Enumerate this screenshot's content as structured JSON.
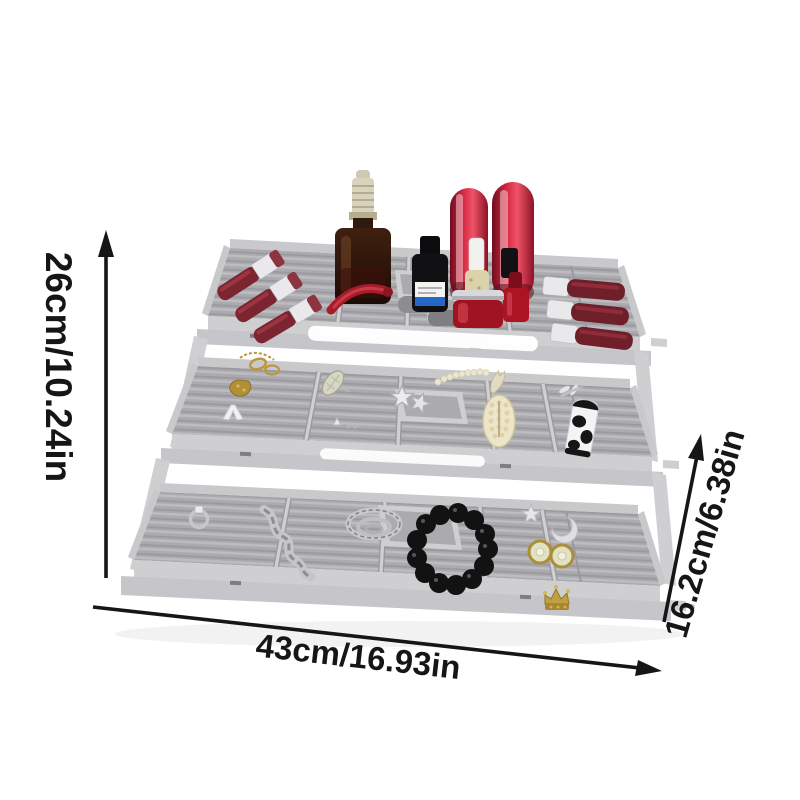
{
  "product": {
    "alt": "Three-tier expandable gray plastic organizer tray filled with lipsticks, serum bottles, nail polish and jewelry"
  },
  "dimensions": {
    "height_label": "26cm/10.24in",
    "width_label": "43cm/16.93in",
    "depth_label": "16.2cm/6.38in"
  },
  "icons": {
    "height_arrow": "up-arrow",
    "width_arrow": "right-arrow",
    "depth_arrow": "up-right-arrow"
  },
  "colors": {
    "background": "#ffffff",
    "arrow": "#161616",
    "tray_face": "#cfcfd2",
    "tray_frame": "#c6c6ca",
    "wall": "#c9c9cc",
    "surface": "#ababaf",
    "ridge": "#bdbdc1",
    "groove": "#9a9a9e",
    "divider": "#d0d0d3",
    "silver": "#e6e6e9",
    "silver_dark": "#b5b5ba",
    "red_dark": "#7c2531",
    "red_bright": "#c8243e",
    "gold": "#bb983c",
    "pearl": "#ece5cf",
    "black_item": "#131313",
    "highlight": "#ffffff"
  }
}
